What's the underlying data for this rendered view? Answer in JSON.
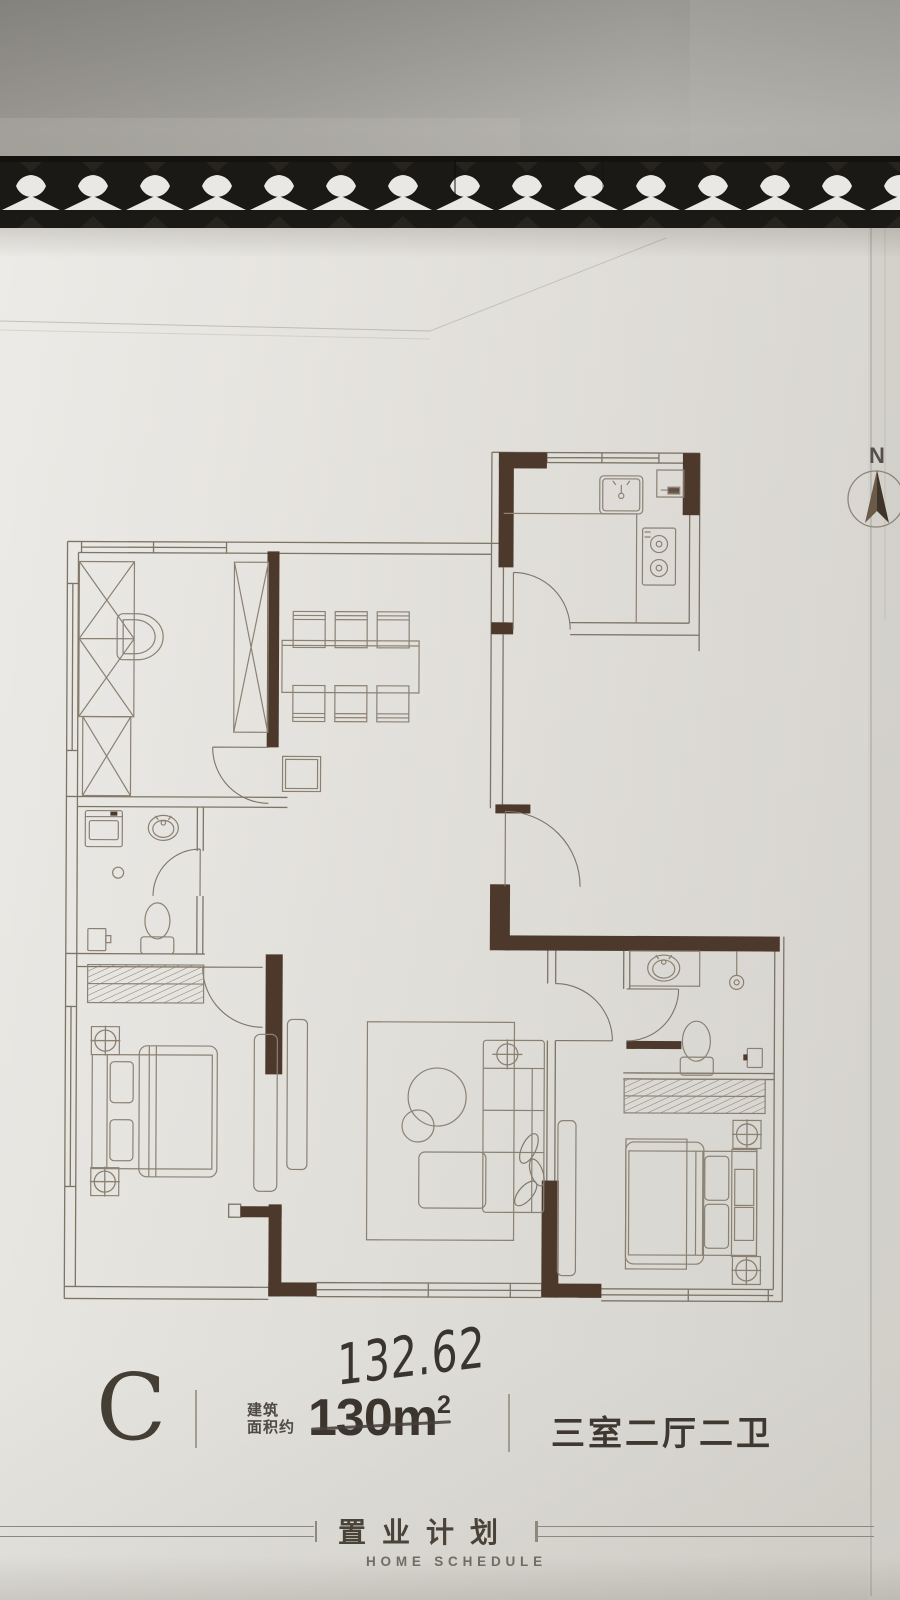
{
  "north": {
    "label": "N"
  },
  "unit": {
    "type_label": "C",
    "area_label_line1": "建筑",
    "area_label_line2": "面积约",
    "area_printed": "130m",
    "area_superscript": "2",
    "area_handwritten": "132.62",
    "layout_label": "三室二厅二卫"
  },
  "footer": {
    "title": "置业计划",
    "subtitle": "HOME SCHEDULE"
  },
  "colors": {
    "wall_dark": "#4d392c",
    "plan_line": "#7d7466",
    "furniture_line": "#8b8173",
    "paper": "#eae8e4",
    "grate_black": "#1b1916",
    "text_dark": "#3b352e"
  }
}
